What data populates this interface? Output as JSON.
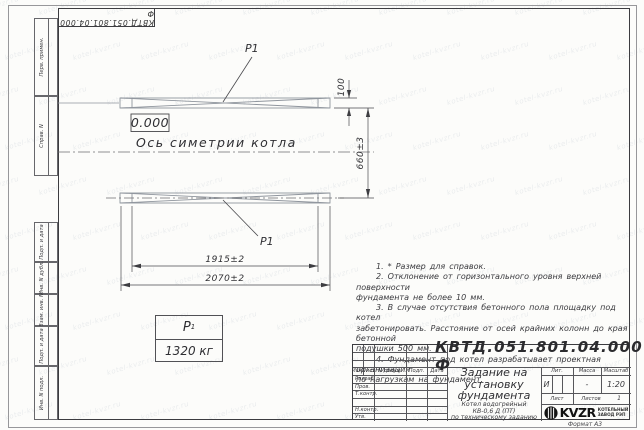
{
  "sheet": {
    "stamp": "КВТД.051.801.04.000 Ф",
    "format_label": "Формат А3",
    "watermark": "kotel-kvzr.ru"
  },
  "margin_labels": {
    "top": [
      "Перв. примен.",
      "Справ. N"
    ],
    "bottom": [
      "Подп. и дата",
      "Инв. N дубл.",
      "Взам. инв. N",
      "Подп. и дата",
      "Инв. N подл."
    ]
  },
  "drawing": {
    "part_label_top": "P1",
    "part_label_bottom": "P1",
    "elevation": "0.000",
    "axis_caption": "Ось симетрии котла",
    "dims": {
      "beam_width": "100",
      "axis_distance": "660±3",
      "inner_span": "1915±2",
      "outer_span": "2070±2"
    }
  },
  "weight_table": {
    "symbol": "P",
    "symbol_sub": "1",
    "value": "1320 кг"
  },
  "notes": {
    "lines": [
      "1. * Размер для справок.",
      "2. Отклонение от горизонтального уровня верхней поверхности",
      "фундамента не более 10 мм.",
      "3. В случае отсутствия бетонного пола площадку под котел",
      "забетонировать. Расстояние от осей крайних колонн до края бетонной",
      "подушки 500 мм.",
      "4. Фундамент под котел разрабатывает проектная организация",
      "по нагрузкам на фундамент."
    ]
  },
  "title_block": {
    "doc_number": "КВТД.051.801.04.000  Ф",
    "title_lines": [
      "Задание на",
      "установку",
      "фундамента"
    ],
    "subtitle_lines": [
      "Котел водогрейный",
      "КВ-0,6 Д (ПТ)",
      "по техническому заданию"
    ],
    "header_cols": [
      "Изм.",
      "Лист",
      "N докум.",
      "Подп.",
      "Дата"
    ],
    "row_labels": [
      "Разраб.",
      "Пров.",
      "Т.контр.",
      "",
      "Н.контр.",
      "Утв."
    ],
    "lit_label": "Лит.",
    "mass_label": "Масса",
    "scale_label": "Масштаб",
    "lit_value": "И",
    "mass_value": "-",
    "scale_value": "1:20",
    "sheet_label": "Лист",
    "sheets_label": "Листов",
    "sheets_value": "1",
    "logo_text": "KVZR",
    "logo_caption_lines": [
      "КОТЕЛЬНЫЙ",
      "ЗАВОД РЭП"
    ]
  }
}
